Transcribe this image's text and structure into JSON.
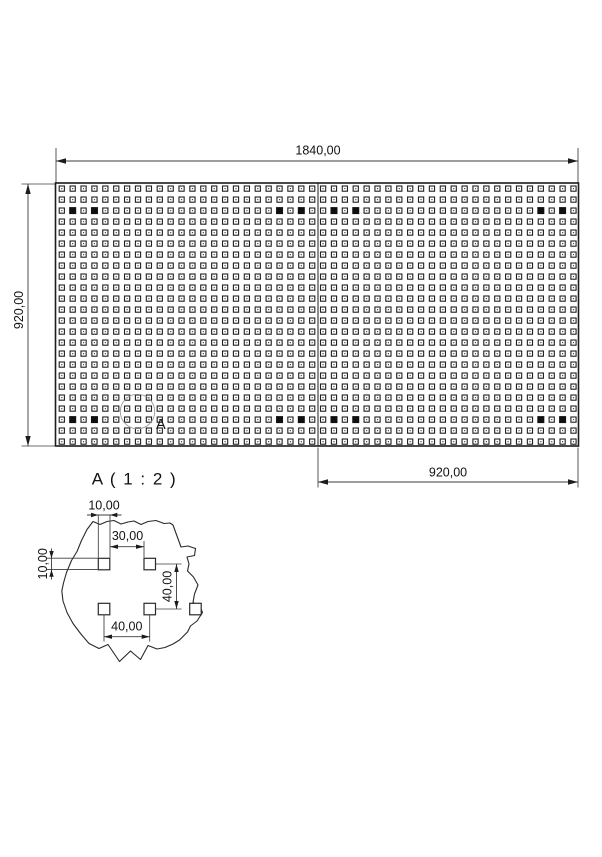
{
  "page": {
    "background": "#ffffff"
  },
  "colors": {
    "line": "#1c1c1c",
    "dimension": "#3c3c3c",
    "callout": "#9a9a9a"
  },
  "main_view": {
    "overall_width_dim": "1840,00",
    "overall_height_dim": "920,00",
    "right_half_width_dim": "920,00",
    "detail_callout_label": "A",
    "grid": {
      "rows": 24,
      "cols": 48,
      "filled": {
        "rows": [
          3,
          22
        ],
        "cols": [
          2,
          4,
          21,
          23,
          26,
          28,
          45,
          47
        ]
      }
    }
  },
  "detail_view": {
    "title": "A ( 1 : 2 )",
    "hole_width_dim": "10,00",
    "hole_height_dim": "10,00",
    "hole_gap_dim": "30,00",
    "vertical_pitch_dim": "40,00",
    "horizontal_pitch_dim": "40,00"
  }
}
